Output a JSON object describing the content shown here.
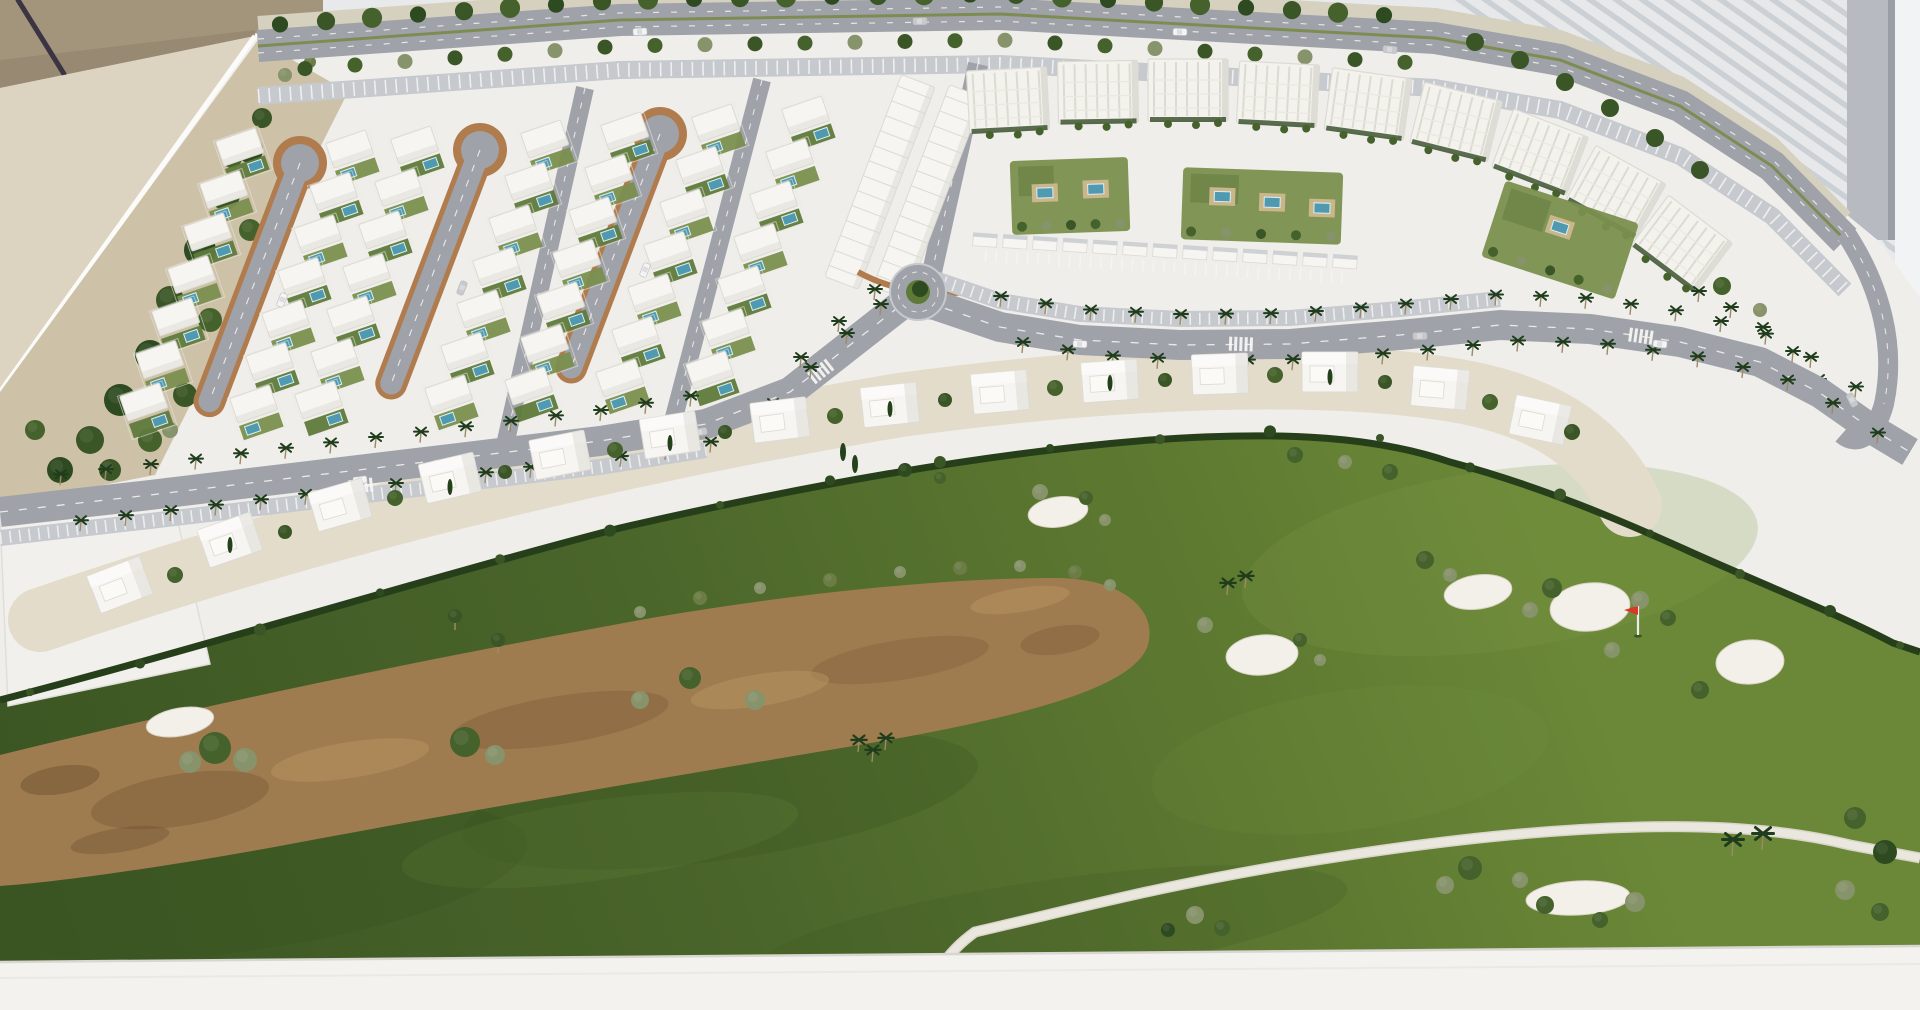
{
  "image": {
    "type": "photograph",
    "subject": "Architectural scale model (maquette) of a golf-resort residential masterplan",
    "view": "oblique aerial view of a white presentation table model",
    "width": 1920,
    "height": 1010
  },
  "model": {
    "districts": [
      {
        "name": "villa-district",
        "desc": "grid of small white detached villas with private blue pools along three teardrop cul-de-sac streets",
        "cul_de_sacs": 3,
        "houses": 40
      },
      {
        "name": "townhouse-block",
        "desc": "two stepped terraced-house rows behind a curved terracotta retaining wall"
      },
      {
        "name": "apartment-district",
        "desc": "arc of multi-storey white apartment blocks with landscaped courtyards and shared pools",
        "blocks": 9,
        "courtyards": 3
      },
      {
        "name": "villa-row",
        "desc": "row of two-storey white villas lining the south side of the palm avenue",
        "villas": 14
      },
      {
        "name": "golf-course",
        "desc": "large green course with sand bunkers, one red pin flag, a dry sandy river wash and a white cart path",
        "bunkers": 7,
        "flags": 1
      }
    ],
    "roads": [
      "tree-lined perimeter boulevard with parking bays",
      "palm-lined curved avenue",
      "one roundabout",
      "three cul-de-sac loops",
      "three service streets"
    ],
    "surroundings": [
      "brown wall corner",
      "beige floor",
      "white wall with diagonal-striped panel",
      "grey pillar",
      "thin dark rod leaning in corner"
    ]
  },
  "colors": {
    "bg": "#e8e9ea",
    "stripeBg": "#e6e8ea",
    "stripeLine": "#cbd0d5",
    "pillar": "#b7bbc1",
    "pillarShade": "#9a9ea5",
    "sliver": "#f2f3f4",
    "wall": "#a3947c",
    "wallShade": "#8f8069",
    "rod": "#3b3442",
    "floor": "#ddd3c1",
    "plate": "#efeeea",
    "rim": "#fbfbf9",
    "baseFront": "#f3f2ef",
    "baseSeam": "#d8d6d0",
    "road": "#9fa2a9",
    "roadLight": "#c6c9ce",
    "roadDark": "#8f929a",
    "lane": "#f6f6f4",
    "tan": "#cdc1a8",
    "loopRim": "#b07c4e",
    "strip": "#e3dccb",
    "plot": "#f1f0ec",
    "treeDark": "#2e4a20",
    "tree": "#3a5526",
    "treeMid": "#46622c",
    "treeLight": "#6b7c44",
    "olive": "#87936a",
    "cypress": "#24411b",
    "house": "#f6f5f1",
    "houseShade": "#dbdad3",
    "garden": "#7a8f4e",
    "gardenDark": "#5f7a3c",
    "pool": "#4f9ab0",
    "poolEdge": "#ddeef2",
    "deck": "#c9b68a",
    "apt": "#f3f2ec",
    "aptLine": "#dcdbd3",
    "hedge": "#263f1a",
    "golfA": "#5e7a31",
    "golfB": "#4a652a",
    "golfC": "#3a5422",
    "golfLight": "#7e9a48",
    "river": "#9f7c50",
    "riverDark": "#7d5b38",
    "riverLight": "#b5915f",
    "bunker": "#f3f0e9",
    "path": "#eae7df",
    "pathEdge": "#d9d5c9",
    "flagRed": "#d8372a",
    "pole": "#ececec",
    "palm": "#1f3d1c",
    "trunk": "#9c8a66",
    "car": "#f4f4f4",
    "carGrey": "#c7c9cc"
  }
}
